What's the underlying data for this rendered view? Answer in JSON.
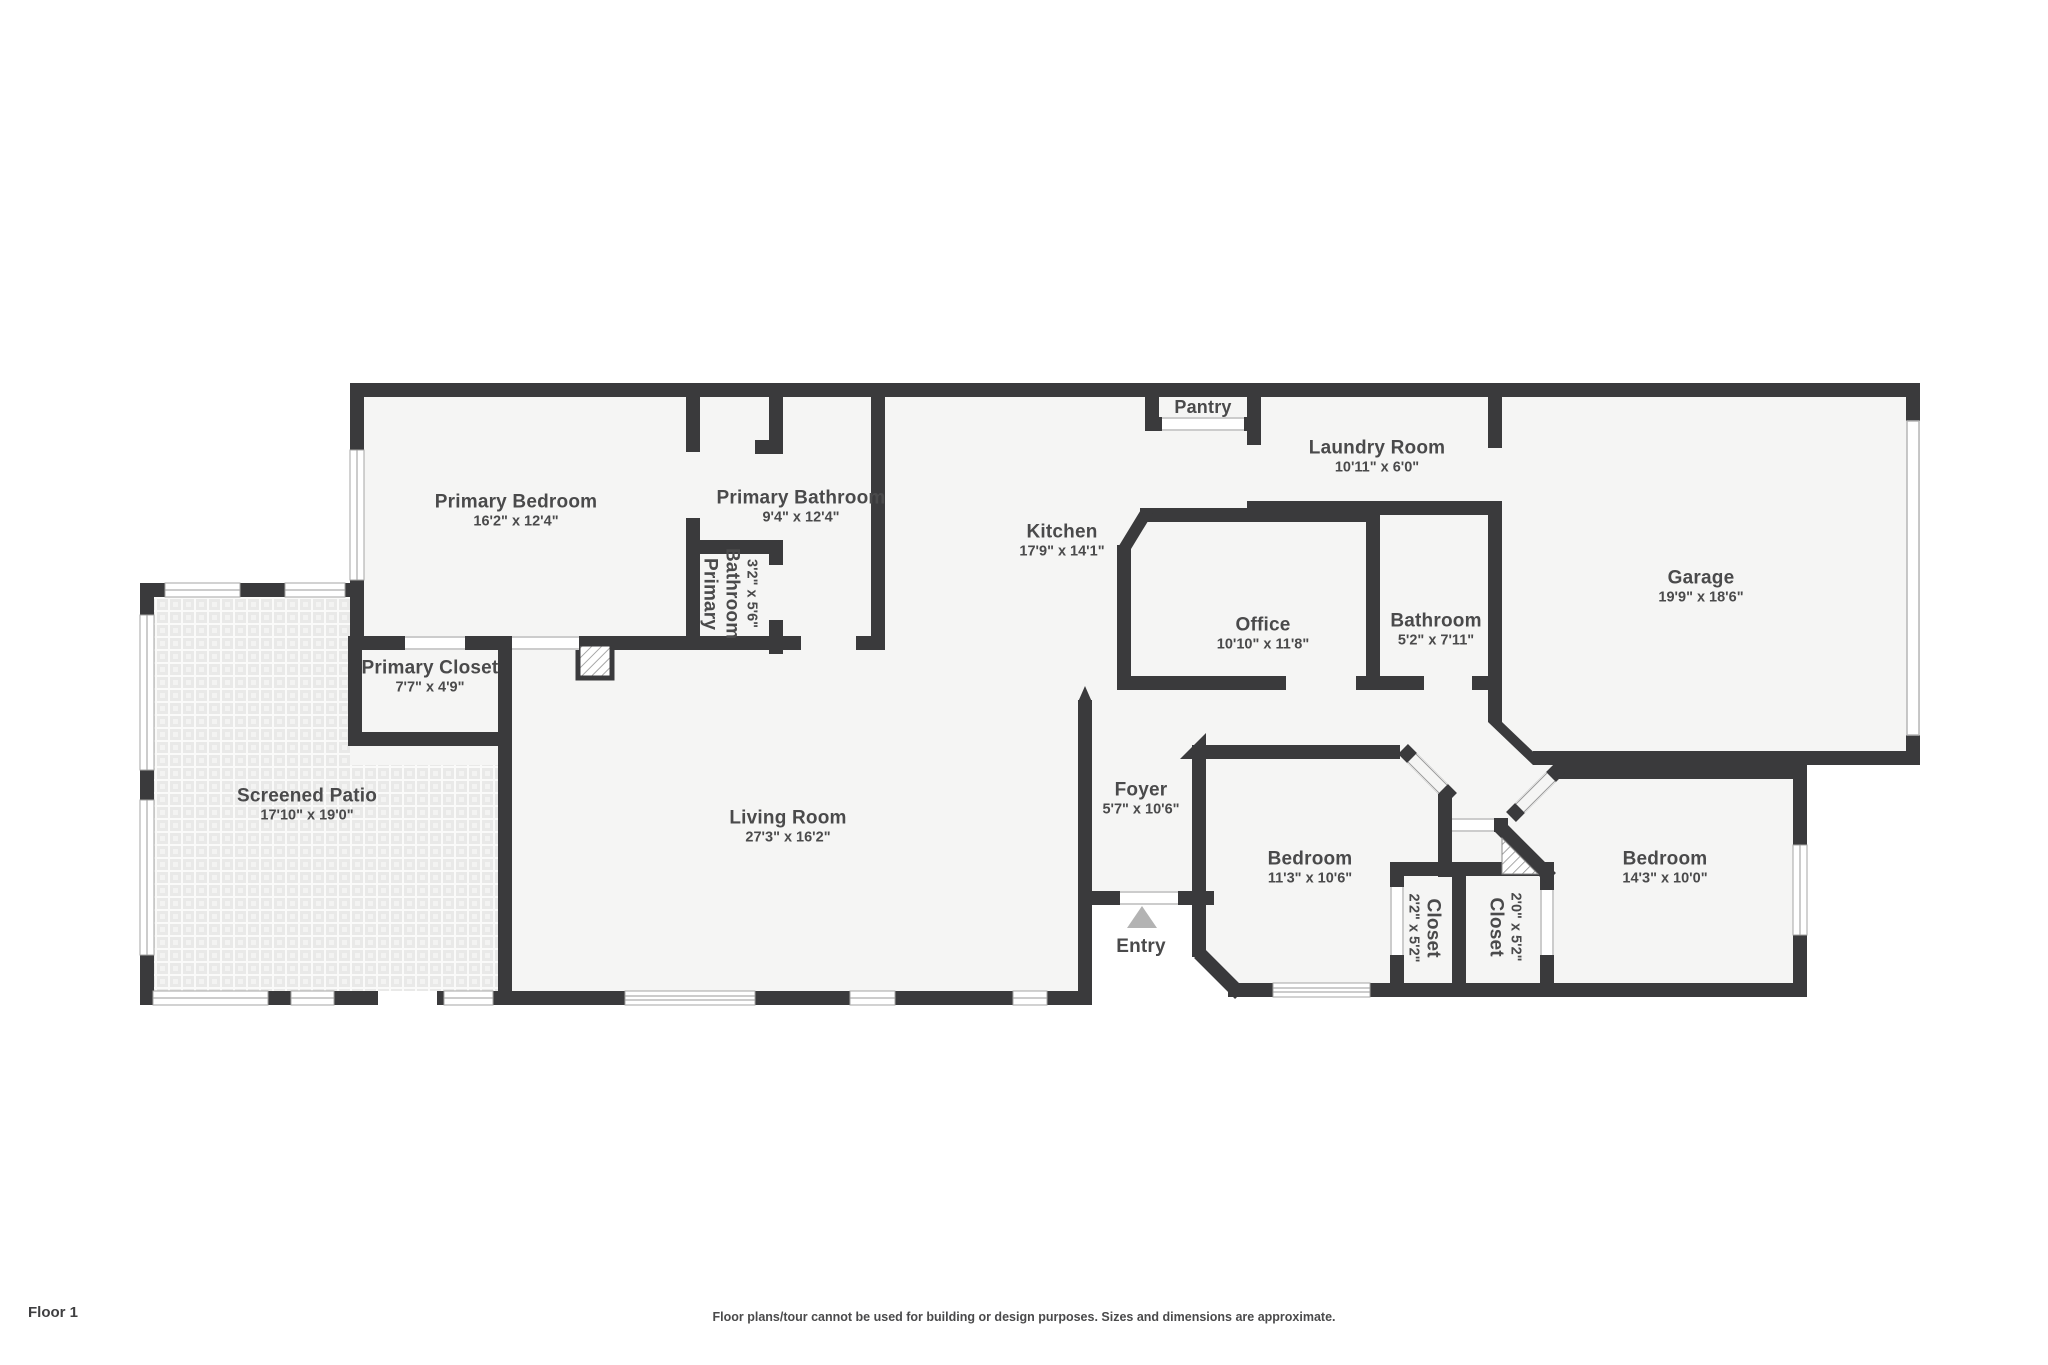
{
  "page": {
    "floor_label": "Floor 1",
    "disclaimer": "Floor plans/tour cannot be used for building or design purposes. Sizes and dimensions are approximate."
  },
  "colors": {
    "wall": "#3a3a3c",
    "floor": "#f5f5f4",
    "patio_tile": "#e9e9e8",
    "text": "#4a4a4b",
    "entry_arrow": "#b3b3b3",
    "window_line": "#9a9a9a"
  },
  "rooms": [
    {
      "id": "primary-bedroom",
      "name": "Primary Bedroom",
      "dims": "16'2\" x 12'4\""
    },
    {
      "id": "primary-bathroom",
      "name": "Primary Bathroom",
      "dims": "9'4\" x 12'4\""
    },
    {
      "id": "primary-bathroom-small",
      "name": "Primary Bathroom",
      "dims": "3'2\" x 5'6\""
    },
    {
      "id": "primary-closet",
      "name": "Primary Closet",
      "dims": "7'7\" x 4'9\""
    },
    {
      "id": "screened-patio",
      "name": "Screened Patio",
      "dims": "17'10\" x 19'0\""
    },
    {
      "id": "living-room",
      "name": "Living Room",
      "dims": "27'3\" x 16'2\""
    },
    {
      "id": "kitchen",
      "name": "Kitchen",
      "dims": "17'9\" x 14'1\""
    },
    {
      "id": "pantry",
      "name": "Pantry",
      "dims": ""
    },
    {
      "id": "laundry-room",
      "name": "Laundry Room",
      "dims": "10'11\" x 6'0\""
    },
    {
      "id": "office",
      "name": "Office",
      "dims": "10'10\" x 11'8\""
    },
    {
      "id": "bathroom",
      "name": "Bathroom",
      "dims": "5'2\" x 7'11\""
    },
    {
      "id": "garage",
      "name": "Garage",
      "dims": "19'9\" x 18'6\""
    },
    {
      "id": "foyer",
      "name": "Foyer",
      "dims": "5'7\" x 10'6\""
    },
    {
      "id": "bedroom-1",
      "name": "Bedroom",
      "dims": "11'3\" x 10'6\""
    },
    {
      "id": "closet-1",
      "name": "Closet",
      "dims": "2'2\" x 5'2\""
    },
    {
      "id": "closet-2",
      "name": "Closet",
      "dims": "2'0\" x 5'2\""
    },
    {
      "id": "bedroom-2",
      "name": "Bedroom",
      "dims": "14'3\" x 10'0\""
    },
    {
      "id": "entry",
      "name": "Entry",
      "dims": ""
    }
  ]
}
